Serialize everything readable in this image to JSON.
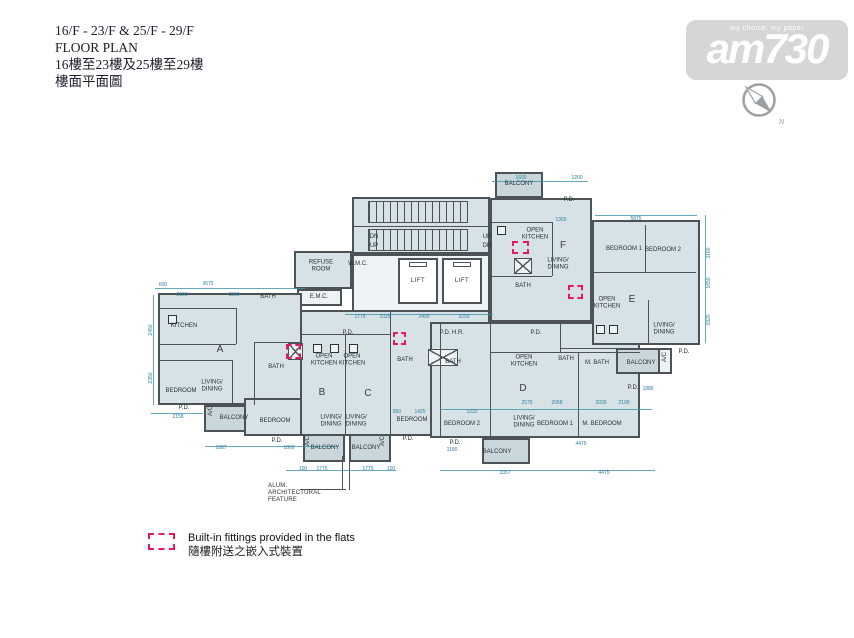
{
  "header": {
    "line1": "16/F - 23/F & 25/F - 29/F",
    "line2": "FLOOR PLAN",
    "line3": "16樓至23樓及25樓至29樓",
    "line4": "樓面平面圖"
  },
  "watermark": {
    "tagline": "my choice, my paper",
    "logo": "am730",
    "compass_n": "N"
  },
  "legend": {
    "en": "Built-in fittings provided in the flats",
    "zh": "隨樓附送之嵌入式裝置"
  },
  "annotation": {
    "text": "ALUM.\nARCHITECTURAL\nFEATURE"
  },
  "colors": {
    "dimension": "#3f93ad",
    "wall": "#4d5256",
    "fitting_red": "#e8185e",
    "room_fill": "#d7e2e7",
    "balcony_fill": "#c9d7dd",
    "watermark_gray": "#d6d6d6"
  },
  "plan": {
    "blocks": [
      {
        "x": 352,
        "y": 197,
        "w": 138,
        "h": 57
      },
      {
        "x": 352,
        "y": 254,
        "w": 138,
        "h": 58,
        "cls": "lite"
      },
      {
        "x": 294,
        "y": 251,
        "w": 58,
        "h": 38
      },
      {
        "x": 297,
        "y": 289,
        "w": 45,
        "h": 17,
        "cls": "lite"
      },
      {
        "x": 158,
        "y": 293,
        "w": 144,
        "h": 112
      },
      {
        "x": 204,
        "y": 405,
        "w": 86,
        "h": 27,
        "cls": "bal"
      },
      {
        "x": 244,
        "y": 398,
        "w": 58,
        "h": 38
      },
      {
        "x": 300,
        "y": 310,
        "w": 190,
        "h": 126
      },
      {
        "x": 303,
        "y": 434,
        "w": 42,
        "h": 28,
        "cls": "bal"
      },
      {
        "x": 349,
        "y": 434,
        "w": 42,
        "h": 28,
        "cls": "bal"
      },
      {
        "x": 430,
        "y": 322,
        "w": 210,
        "h": 116
      },
      {
        "x": 482,
        "y": 438,
        "w": 48,
        "h": 26,
        "cls": "bal"
      },
      {
        "x": 490,
        "y": 198,
        "w": 102,
        "h": 124
      },
      {
        "x": 495,
        "y": 172,
        "w": 48,
        "h": 26,
        "cls": "bal"
      },
      {
        "x": 592,
        "y": 220,
        "w": 108,
        "h": 125
      },
      {
        "x": 616,
        "y": 348,
        "w": 44,
        "h": 26,
        "cls": "bal"
      },
      {
        "x": 658,
        "y": 348,
        "w": 14,
        "h": 26,
        "cls": "lite"
      },
      {
        "x": 368,
        "y": 201,
        "w": 100,
        "h": 22,
        "cls": "stairs"
      },
      {
        "x": 368,
        "y": 229,
        "w": 100,
        "h": 22,
        "cls": "stairs"
      },
      {
        "x": 514,
        "y": 258,
        "w": 18,
        "h": 16,
        "cls": "xbox"
      },
      {
        "x": 288,
        "y": 343,
        "w": 15,
        "h": 17,
        "cls": "xbox"
      },
      {
        "x": 428,
        "y": 349,
        "w": 30,
        "h": 17,
        "cls": "xbox"
      }
    ],
    "walls": [
      {
        "x": 158,
        "y": 308,
        "w": 78,
        "h": 1
      },
      {
        "x": 158,
        "y": 344,
        "w": 78,
        "h": 1
      },
      {
        "x": 236,
        "y": 308,
        "w": 1,
        "h": 36
      },
      {
        "x": 158,
        "y": 360,
        "w": 74,
        "h": 1
      },
      {
        "x": 232,
        "y": 360,
        "w": 1,
        "h": 45
      },
      {
        "x": 254,
        "y": 342,
        "w": 48,
        "h": 1
      },
      {
        "x": 254,
        "y": 342,
        "w": 1,
        "h": 63
      },
      {
        "x": 345,
        "y": 334,
        "w": 1,
        "h": 100
      },
      {
        "x": 390,
        "y": 310,
        "w": 1,
        "h": 126
      },
      {
        "x": 300,
        "y": 334,
        "w": 90,
        "h": 1
      },
      {
        "x": 440,
        "y": 322,
        "w": 1,
        "h": 116
      },
      {
        "x": 490,
        "y": 322,
        "w": 1,
        "h": 116
      },
      {
        "x": 490,
        "y": 352,
        "w": 150,
        "h": 1
      },
      {
        "x": 560,
        "y": 322,
        "w": 1,
        "h": 30
      },
      {
        "x": 560,
        "y": 348,
        "w": 80,
        "h": 1
      },
      {
        "x": 578,
        "y": 352,
        "w": 1,
        "h": 86
      },
      {
        "x": 490,
        "y": 222,
        "w": 62,
        "h": 1
      },
      {
        "x": 552,
        "y": 222,
        "w": 1,
        "h": 54
      },
      {
        "x": 490,
        "y": 276,
        "w": 62,
        "h": 1
      },
      {
        "x": 592,
        "y": 272,
        "w": 104,
        "h": 1
      },
      {
        "x": 645,
        "y": 225,
        "w": 1,
        "h": 47
      },
      {
        "x": 648,
        "y": 300,
        "w": 1,
        "h": 45
      },
      {
        "x": 352,
        "y": 226,
        "w": 138,
        "h": 1
      },
      {
        "x": 300,
        "y": 489,
        "w": 46,
        "h": 1
      },
      {
        "x": 342,
        "y": 456,
        "w": 1,
        "h": 34
      },
      {
        "x": 349,
        "y": 456,
        "w": 1,
        "h": 34
      }
    ],
    "dimlines": [
      {
        "x": 155,
        "y": 288,
        "w": 150,
        "h": 1
      },
      {
        "x": 153,
        "y": 295,
        "w": 1,
        "h": 110
      },
      {
        "x": 205,
        "y": 446,
        "w": 132,
        "h": 1
      },
      {
        "x": 286,
        "y": 470,
        "w": 110,
        "h": 1
      },
      {
        "x": 440,
        "y": 470,
        "w": 215,
        "h": 1
      },
      {
        "x": 440,
        "y": 409,
        "w": 212,
        "h": 1
      },
      {
        "x": 492,
        "y": 181,
        "w": 96,
        "h": 1
      },
      {
        "x": 595,
        "y": 215,
        "w": 102,
        "h": 1
      },
      {
        "x": 345,
        "y": 314,
        "w": 148,
        "h": 1
      },
      {
        "x": 705,
        "y": 215,
        "w": 1,
        "h": 128
      },
      {
        "x": 151,
        "y": 413,
        "w": 52,
        "h": 1
      }
    ],
    "lifts": [
      {
        "t": "LIFT",
        "x": 398,
        "y": 258,
        "w": 40,
        "h": 46
      },
      {
        "t": "LIFT",
        "x": 442,
        "y": 258,
        "w": 40,
        "h": 46
      }
    ],
    "fixtures": [
      {
        "x": 313,
        "y": 344,
        "w": 9,
        "h": 9
      },
      {
        "x": 330,
        "y": 344,
        "w": 9,
        "h": 9
      },
      {
        "x": 349,
        "y": 344,
        "w": 9,
        "h": 9
      },
      {
        "x": 168,
        "y": 315,
        "w": 9,
        "h": 9
      },
      {
        "x": 497,
        "y": 226,
        "w": 9,
        "h": 9
      },
      {
        "x": 596,
        "y": 325,
        "w": 9,
        "h": 9
      },
      {
        "x": 609,
        "y": 325,
        "w": 9,
        "h": 9
      }
    ],
    "fittings": [
      {
        "x": 286,
        "y": 344,
        "w": 15,
        "h": 15
      },
      {
        "x": 393,
        "y": 332,
        "w": 13,
        "h": 13
      },
      {
        "x": 512,
        "y": 241,
        "w": 17,
        "h": 13
      },
      {
        "x": 568,
        "y": 285,
        "w": 15,
        "h": 14
      }
    ],
    "rooms": [
      {
        "t": "REFUSE\nROOM",
        "x": 321,
        "y": 266
      },
      {
        "t": "W.M.C.",
        "x": 358,
        "y": 264
      },
      {
        "t": "E.M.C.",
        "x": 319,
        "y": 297
      },
      {
        "t": "DN",
        "x": 374,
        "y": 237
      },
      {
        "t": "UP",
        "x": 374,
        "y": 246
      },
      {
        "t": "UP",
        "x": 487,
        "y": 237
      },
      {
        "t": "DN",
        "x": 487,
        "y": 246
      },
      {
        "t": "KITCHEN",
        "x": 184,
        "y": 326
      },
      {
        "t": "BATH",
        "x": 268,
        "y": 297
      },
      {
        "t": "LIVING/\nDINING",
        "x": 212,
        "y": 386
      },
      {
        "t": "BEDROOM",
        "x": 181,
        "y": 391
      },
      {
        "t": "P.D.",
        "x": 184,
        "y": 408
      },
      {
        "t": "BALCONY",
        "x": 234,
        "y": 418
      },
      {
        "t": "A/C",
        "x": 211,
        "y": 411,
        "v": true
      },
      {
        "t": "A",
        "x": 220,
        "y": 350,
        "b": true
      },
      {
        "t": "BATH",
        "x": 276,
        "y": 367
      },
      {
        "t": "BEDROOM",
        "x": 275,
        "y": 421
      },
      {
        "t": "OPEN\nKITCHEN",
        "x": 324,
        "y": 360
      },
      {
        "t": "OPEN\nKITCHEN",
        "x": 352,
        "y": 360
      },
      {
        "t": "LIVING/\nDINING",
        "x": 331,
        "y": 421
      },
      {
        "t": "LIVING/\nDINING",
        "x": 356,
        "y": 421
      },
      {
        "t": "P.D.",
        "x": 277,
        "y": 441
      },
      {
        "t": "BALCONY",
        "x": 325,
        "y": 448
      },
      {
        "t": "BALCONY",
        "x": 366,
        "y": 448
      },
      {
        "t": "A/C",
        "x": 308,
        "y": 441,
        "v": true
      },
      {
        "t": "A/C",
        "x": 383,
        "y": 441,
        "v": true
      },
      {
        "t": "B",
        "x": 322,
        "y": 393,
        "b": true
      },
      {
        "t": "C",
        "x": 368,
        "y": 394,
        "b": true
      },
      {
        "t": "P.D.",
        "x": 348,
        "y": 333
      },
      {
        "t": "P.D.",
        "x": 445,
        "y": 333
      },
      {
        "t": "H.R.",
        "x": 458,
        "y": 333
      },
      {
        "t": "BATH",
        "x": 405,
        "y": 360
      },
      {
        "t": "BATH",
        "x": 453,
        "y": 362
      },
      {
        "t": "BEDROOM",
        "x": 412,
        "y": 420
      },
      {
        "t": "BEDROOM 2",
        "x": 462,
        "y": 424
      },
      {
        "t": "P.D.",
        "x": 408,
        "y": 439
      },
      {
        "t": "P.D.",
        "x": 455,
        "y": 443
      },
      {
        "t": "P.D.",
        "x": 536,
        "y": 333
      },
      {
        "t": "OPEN\nKITCHEN",
        "x": 524,
        "y": 361
      },
      {
        "t": "BATH",
        "x": 566,
        "y": 359
      },
      {
        "t": "M. BATH",
        "x": 597,
        "y": 363
      },
      {
        "t": "BALCONY",
        "x": 641,
        "y": 363
      },
      {
        "t": "A/C",
        "x": 665,
        "y": 357,
        "v": true
      },
      {
        "t": "P.D.",
        "x": 684,
        "y": 352
      },
      {
        "t": "LIVING/\nDINING",
        "x": 524,
        "y": 422
      },
      {
        "t": "BEDROOM 1",
        "x": 555,
        "y": 424
      },
      {
        "t": "M. BEDROOM",
        "x": 602,
        "y": 424
      },
      {
        "t": "P.D.",
        "x": 633,
        "y": 388
      },
      {
        "t": "BALCONY",
        "x": 497,
        "y": 452
      },
      {
        "t": "D",
        "x": 523,
        "y": 389,
        "b": true
      },
      {
        "t": "BALCONY",
        "x": 519,
        "y": 184
      },
      {
        "t": "P.D.",
        "x": 569,
        "y": 200
      },
      {
        "t": "OPEN\nKITCHEN",
        "x": 535,
        "y": 234
      },
      {
        "t": "LIVING/\nDINING",
        "x": 558,
        "y": 264
      },
      {
        "t": "BATH",
        "x": 523,
        "y": 286
      },
      {
        "t": "F",
        "x": 563,
        "y": 246,
        "b": true
      },
      {
        "t": "BEDROOM 1",
        "x": 624,
        "y": 249
      },
      {
        "t": "BEDROOM 2",
        "x": 663,
        "y": 250
      },
      {
        "t": "OPEN\nKITCHEN",
        "x": 607,
        "y": 303
      },
      {
        "t": "LIVING/\nDINING",
        "x": 664,
        "y": 329
      },
      {
        "t": "E",
        "x": 632,
        "y": 300,
        "b": true
      }
    ],
    "dims": [
      {
        "t": "600",
        "x": 163,
        "y": 285
      },
      {
        "t": "3675",
        "x": 208,
        "y": 284
      },
      {
        "t": "2150",
        "x": 182,
        "y": 295
      },
      {
        "t": "1300",
        "x": 234,
        "y": 295
      },
      {
        "t": "1775",
        "x": 360,
        "y": 317
      },
      {
        "t": "1025",
        "x": 385,
        "y": 317
      },
      {
        "t": "2400",
        "x": 424,
        "y": 317
      },
      {
        "t": "3250",
        "x": 464,
        "y": 317
      },
      {
        "t": "1600",
        "x": 521,
        "y": 178
      },
      {
        "t": "1200",
        "x": 577,
        "y": 178
      },
      {
        "t": "1365",
        "x": 561,
        "y": 220
      },
      {
        "t": "5875",
        "x": 636,
        "y": 219
      },
      {
        "t": "2158",
        "x": 178,
        "y": 417
      },
      {
        "t": "1887",
        "x": 221,
        "y": 448
      },
      {
        "t": "1800",
        "x": 289,
        "y": 448
      },
      {
        "t": "100",
        "x": 303,
        "y": 469
      },
      {
        "t": "1775",
        "x": 322,
        "y": 469
      },
      {
        "t": "1775",
        "x": 368,
        "y": 469
      },
      {
        "t": "100",
        "x": 391,
        "y": 469
      },
      {
        "t": "3357",
        "x": 505,
        "y": 473
      },
      {
        "t": "4475",
        "x": 604,
        "y": 473
      },
      {
        "t": "4475",
        "x": 581,
        "y": 444
      },
      {
        "t": "850",
        "x": 397,
        "y": 412
      },
      {
        "t": "1425",
        "x": 420,
        "y": 412
      },
      {
        "t": "1232",
        "x": 472,
        "y": 412
      },
      {
        "t": "2575",
        "x": 527,
        "y": 403
      },
      {
        "t": "2058",
        "x": 557,
        "y": 403
      },
      {
        "t": "2030",
        "x": 601,
        "y": 403
      },
      {
        "t": "2100",
        "x": 624,
        "y": 403
      },
      {
        "t": "1886",
        "x": 648,
        "y": 389
      },
      {
        "t": "1190",
        "x": 452,
        "y": 450
      },
      {
        "t": "2450",
        "x": 151,
        "y": 330,
        "v": true
      },
      {
        "t": "2350",
        "x": 151,
        "y": 378,
        "v": true
      },
      {
        "t": "1100",
        "x": 709,
        "y": 253,
        "v": true
      },
      {
        "t": "1650",
        "x": 709,
        "y": 283,
        "v": true
      },
      {
        "t": "3320",
        "x": 709,
        "y": 320,
        "v": true
      }
    ]
  }
}
